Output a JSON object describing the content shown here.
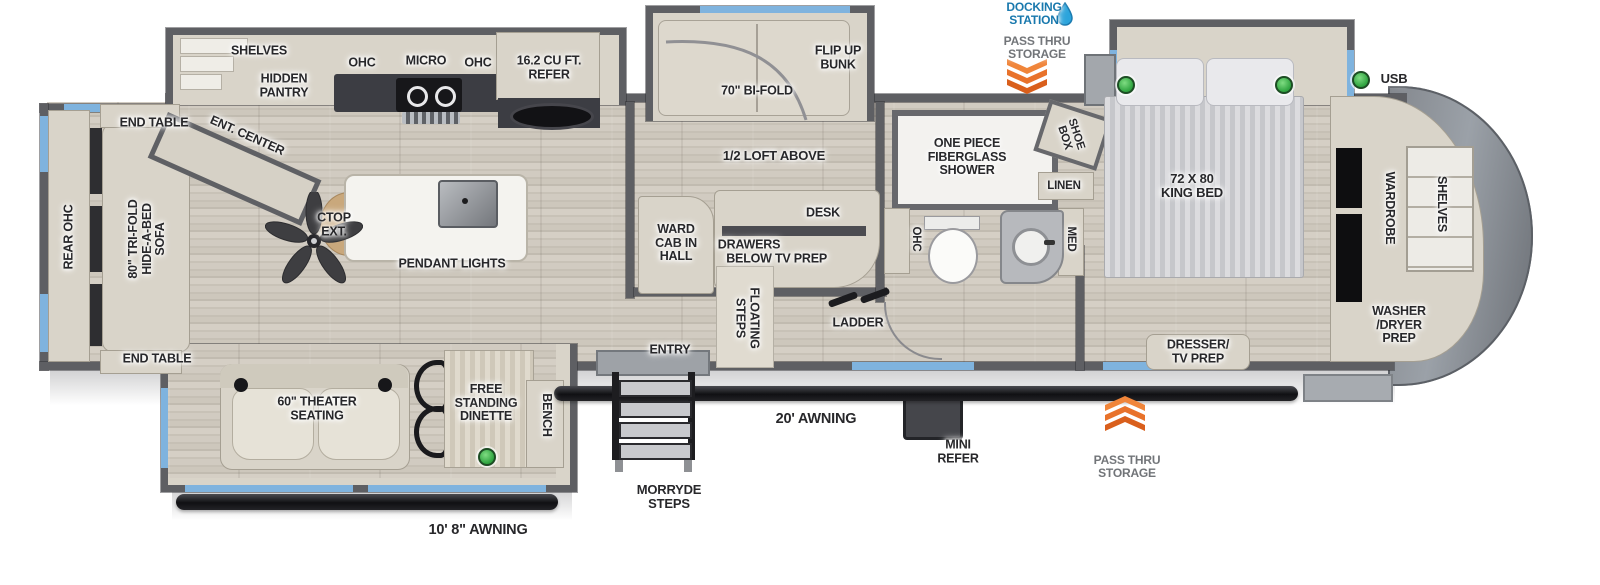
{
  "title": "Fifth wheel RV floorplan diagram",
  "colors": {
    "wall": "#5e5f63",
    "floor_wood": "#cbc5ba",
    "cabinet_beige": "#d9d4c9",
    "counter_dark": "#3c3d43",
    "window_blue": "#7fb3de",
    "island_white": "#f4f3ef",
    "front_cap_gray": "#8b9096",
    "docking_text_blue": "#1878ad",
    "passthru_text_gray": "#717478",
    "arrow_orange": "#e8722b",
    "usb_led_green": "#2ea33f",
    "awning_bar_black": "#141417",
    "label_text": "#27272a"
  },
  "icons": {
    "water_drop": "blue teardrop beside DOCKING STATION",
    "chevron_down": "triple orange chevrons pointing down (top pass thru storage)",
    "chevron_up": "triple orange chevrons pointing up (bottom pass thru storage)",
    "usb_led": "green dot marking USB charging locations",
    "ceiling_fan": "5-blade ceiling fan in living area",
    "pendant_light_fixture": "gray fixture on kitchen island",
    "stove": "2-burner cooktop with grill",
    "kitchen_sink": "black oval sink",
    "toilet": "toilet in bathroom",
    "bath_sink": "round vanity sink"
  },
  "labels": {
    "end_table_top": "END TABLE",
    "rear_ohc": "REAR OHC",
    "sofa": "80\" TRI-FOLD\nHIDE-A-BED\nSOFA",
    "end_table_bottom": "END TABLE",
    "ent_center": "ENT. CENTER",
    "shelves_rear": "SHELVES",
    "hidden_pantry": "HIDDEN\nPANTRY",
    "ohc_left": "OHC",
    "micro": "MICRO",
    "ohc_right": "OHC",
    "refer": "16.2 CU FT.\nREFER",
    "ctop_ext": "CTOP\nEXT.",
    "pendant_lights": "PENDANT LIGHTS",
    "bifold": "70\" BI-FOLD",
    "flip_up_bunk": "FLIP UP\nBUNK",
    "half_loft": "1/2 LOFT ABOVE",
    "ward_cab": "WARD\nCAB IN\nHALL",
    "drawers_below": "DRAWERS\nBELOW",
    "desk": "DESK",
    "tv_prep": "TV PREP",
    "floating_steps": "FLOATING\nSTEPS",
    "ladder": "LADDER",
    "entry": "ENTRY",
    "shower": "ONE PIECE\nFIBERGLASS\nSHOWER",
    "shoe_box": "SHOE\nBOX",
    "linen": "LINEN",
    "ohc_bath": "OHC",
    "med": "MED",
    "king_bed": "72 X 80\nKING BED",
    "usb": "USB",
    "wardrobe": "WARDROBE",
    "shelves_front": "SHELVES",
    "washer_dryer": "WASHER\n/DRYER\nPREP",
    "dresser_tv": "DRESSER/\nTV PREP",
    "docking_station": "DOCKING\nSTATION",
    "pass_thru_top": "PASS THRU\nSTORAGE",
    "pass_thru_bottom": "PASS THRU\nSTORAGE",
    "mini_refer": "MINI\nREFER",
    "awning_20": "20' AWNING",
    "awning_10_8": "10' 8\" AWNING",
    "morryde_steps": "MORRYDE\nSTEPS",
    "theater_seating": "60\" THEATER\nSEATING",
    "dinette": "FREE\nSTANDING\nDINETTE",
    "bench": "BENCH"
  }
}
